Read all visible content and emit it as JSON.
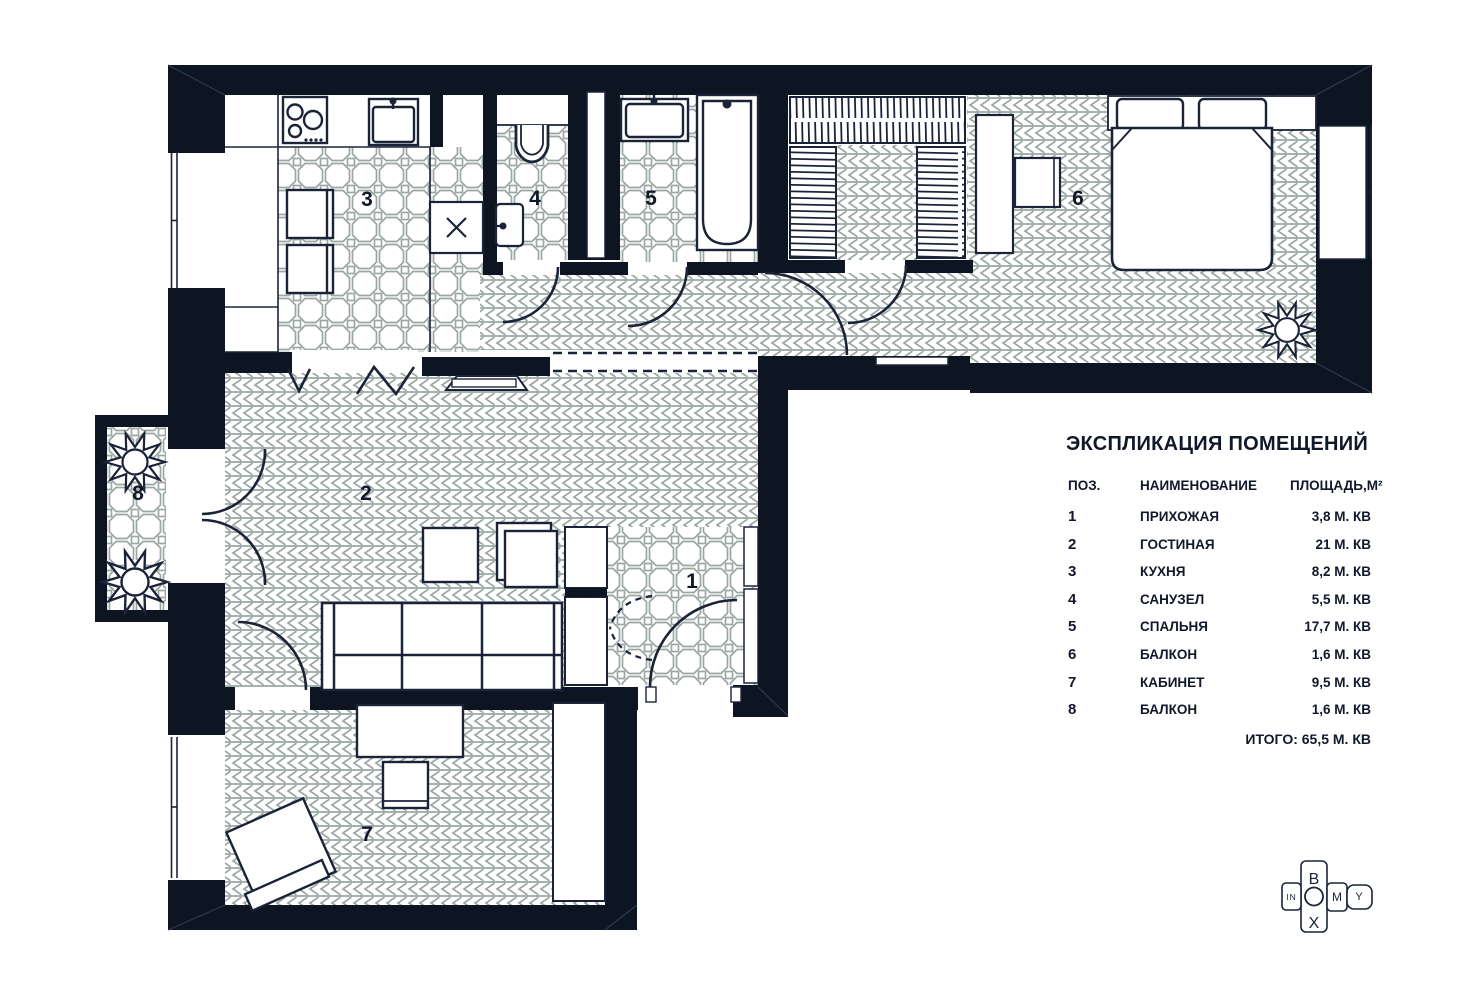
{
  "explication": {
    "title": "ЭКСПЛИКАЦИЯ ПОМЕЩЕНИЙ",
    "columns": {
      "pos": "ПОЗ.",
      "name": "НАИМЕНОВАНИЕ",
      "area": "ПЛОЩАДЬ,М²"
    },
    "rows": [
      {
        "pos": "1",
        "name": "ПРИХОЖАЯ",
        "area": "3,8 М. КВ"
      },
      {
        "pos": "2",
        "name": "ГОСТИНАЯ",
        "area": "21 М. КВ"
      },
      {
        "pos": "3",
        "name": "КУХНЯ",
        "area": "8,2 М. КВ"
      },
      {
        "pos": "4",
        "name": "САНУЗЕЛ",
        "area": "5,5 М. КВ"
      },
      {
        "pos": "5",
        "name": "СПАЛЬНЯ",
        "area": "17,7 М. КВ"
      },
      {
        "pos": "6",
        "name": "БАЛКОН",
        "area": "1,6 М. КВ"
      },
      {
        "pos": "7",
        "name": "КАБИНЕТ",
        "area": "9,5 М. КВ"
      },
      {
        "pos": "8",
        "name": "БАЛКОН",
        "area": "1,6 М. КВ"
      }
    ],
    "total": "ИТОГО: 65,5 М. КВ"
  },
  "plan": {
    "room_numbers": {
      "hallway": "1",
      "living": "2",
      "kitchen": "3",
      "wc": "4",
      "bathroom": "5",
      "balcony_right": "6",
      "study": "7",
      "balcony_left": "8"
    }
  },
  "logo": {
    "letter_b": "B",
    "letter_o": "O",
    "letter_x": "X",
    "word_in": "IN",
    "letter_m": "M",
    "letter_y": "Y"
  },
  "colors": {
    "wall": "#0e1522",
    "line": "#1a2338",
    "floor_pattern": "#9aa7a2",
    "text": "#10182a"
  }
}
